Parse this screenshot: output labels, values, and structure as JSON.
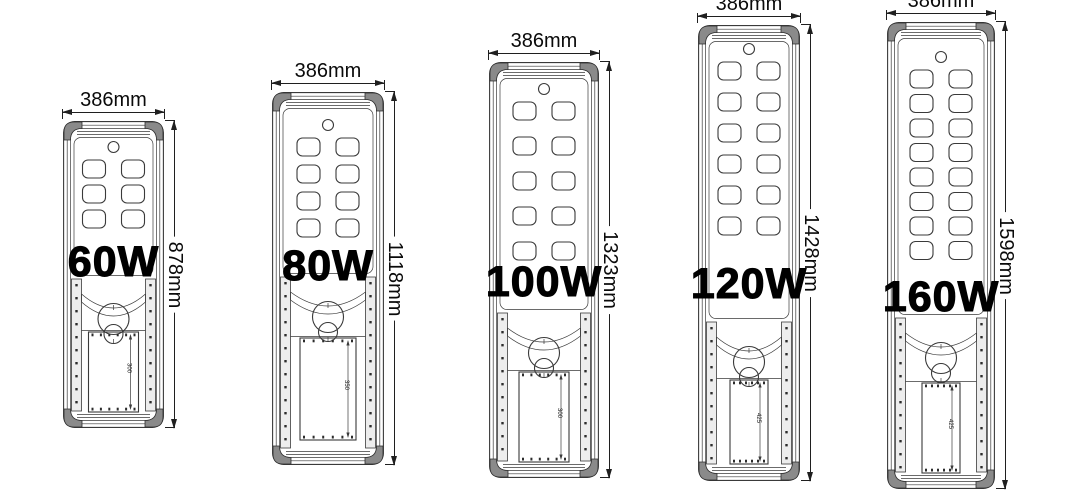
{
  "style": {
    "background": "#ffffff",
    "line_color": "#3a3a3a",
    "dimension_color": "#1f1f1f",
    "cap_fill": "#8a8a8a",
    "text_color": "#0a0a0a"
  },
  "lamps": [
    {
      "id": "lamp-60w",
      "wattage_label": "60W",
      "width_label": "386mm",
      "height_label": "878mm",
      "battery_dim_label": "300",
      "led_rows": 3,
      "led_cols": 2,
      "layout": {
        "body_x": 63,
        "body_y": 121,
        "body_w": 101,
        "body_h": 307,
        "led_top": 39,
        "led_pitch": 25,
        "lower_top": 158,
        "batt_y": 211,
        "batt_h": 80,
        "batt_w": 50,
        "watt_cy": 263,
        "watt_size": 43
      }
    },
    {
      "id": "lamp-80w",
      "wattage_label": "80W",
      "width_label": "386mm",
      "height_label": "1118mm",
      "battery_dim_label": "350",
      "led_rows": 4,
      "led_cols": 2,
      "layout": {
        "body_x": 272,
        "body_y": 92,
        "body_w": 112,
        "body_h": 373,
        "led_top": 46,
        "led_pitch": 27,
        "lower_top": 185,
        "batt_y": 246,
        "batt_h": 102,
        "batt_w": 56,
        "watt_cy": 267,
        "watt_size": 43
      }
    },
    {
      "id": "lamp-100w",
      "wattage_label": "100W",
      "width_label": "386mm",
      "height_label": "1323mm",
      "battery_dim_label": "300",
      "led_rows": 5,
      "led_cols": 2,
      "layout": {
        "body_x": 489,
        "body_y": 62,
        "body_w": 110,
        "body_h": 416,
        "led_top": 40,
        "led_pitch": 35,
        "lower_top": 251,
        "batt_y": 310,
        "batt_h": 90,
        "batt_w": 50,
        "watt_cy": 283,
        "watt_size": 43
      }
    },
    {
      "id": "lamp-120w",
      "wattage_label": "120W",
      "width_label": "386mm",
      "height_label": "1428mm",
      "battery_dim_label": "425",
      "led_rows": 6,
      "led_cols": 2,
      "layout": {
        "body_x": 698,
        "body_y": 25,
        "body_w": 102,
        "body_h": 456,
        "led_top": 37,
        "led_pitch": 31,
        "lower_top": 297,
        "batt_y": 355,
        "batt_h": 84,
        "batt_w": 38,
        "watt_cy": 285,
        "watt_size": 43
      }
    },
    {
      "id": "lamp-160w",
      "wattage_label": "160W",
      "width_label": "386mm",
      "height_label": "1598mm",
      "battery_dim_label": "425",
      "led_rows": 8,
      "led_cols": 2,
      "layout": {
        "body_x": 887,
        "body_y": 22,
        "body_w": 108,
        "body_h": 467,
        "led_top": 48,
        "led_pitch": 24.5,
        "lower_top": 296,
        "batt_y": 361,
        "batt_h": 90,
        "batt_w": 38,
        "watt_cy": 298,
        "watt_size": 43
      }
    }
  ]
}
